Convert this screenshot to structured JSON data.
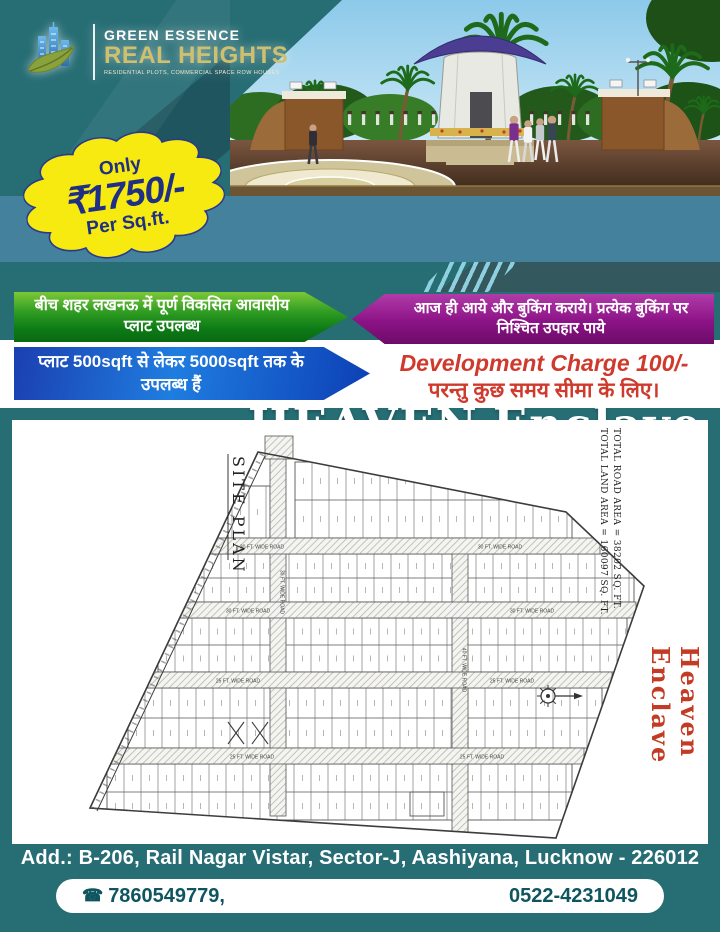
{
  "colors": {
    "teal_bg": "#266d74",
    "title_band": "#44819d",
    "accent_stripe": "#8fd0e0",
    "badge_yellow": "#f7ea10",
    "badge_text": "#1e2f85",
    "green_ribbon": "#128a1a",
    "magenta_ribbon": "#8c1386",
    "blue_ribbon": "#1b57cf",
    "red_text": "#cf3a2d",
    "logo_gold": "#cfc06e",
    "watermark_red": "#c33b25"
  },
  "logo": {
    "line1": "GREEN ESSENCE",
    "line2": "REAL HEIGHTS",
    "tagline": "RESIDENTIAL PLOTS, COMMERCIAL SPACE ROW HOUSES"
  },
  "price_badge": {
    "prefix": "Only",
    "amount": "₹1750/-",
    "suffix": "Per Sq.ft."
  },
  "title": {
    "word1": "HEAVEN",
    "word2": "Enclave"
  },
  "offers": {
    "green_ribbon": "बीच शहर लखनऊ में पूर्ण विकसित आवासीय प्लाट उपलब्ध",
    "magenta_ribbon": "आज ही आये और बुकिंग कराये। प्रत्येक बुकिंग पर निश्चित उपहार पाये",
    "blue_ribbon": "प्लाट 500sqft से लेकर 5000sqft तक के उपलब्ध हैं",
    "dev_charge_line1": "Development Charge 100/-",
    "dev_charge_line2": "परन्तु कुछ समय सीमा के लिए।"
  },
  "site_plan": {
    "label": "SITE PLAN",
    "total_land": "TOTAL LAND AREA = 160097 SQ. FT.",
    "total_road": "TOTAL ROAD AREA = 38202 SQ. FT.",
    "watermark": "Heaven Enclave",
    "roads": [
      "30 FT. WIDE ROAD",
      "30 FT. WIDE ROAD",
      "30 FT. WIDE ROAD",
      "30 FT. WIDE ROAD",
      "25 FT. WIDE ROAD",
      "25 FT. WIDE ROAD",
      "25 FT. WIDE ROAD",
      "25 FT. WIDE ROAD",
      "30 FT. WIDE ROAD",
      "40 FT. WIDE ROAD"
    ]
  },
  "footer": {
    "address": "Add.: B-206, Rail Nagar Vistar, Sector-J, Aashiyana, Lucknow - 226012",
    "phone_icon": "☎",
    "phone1": "7860549779,",
    "phone2": "0522-4231049"
  }
}
